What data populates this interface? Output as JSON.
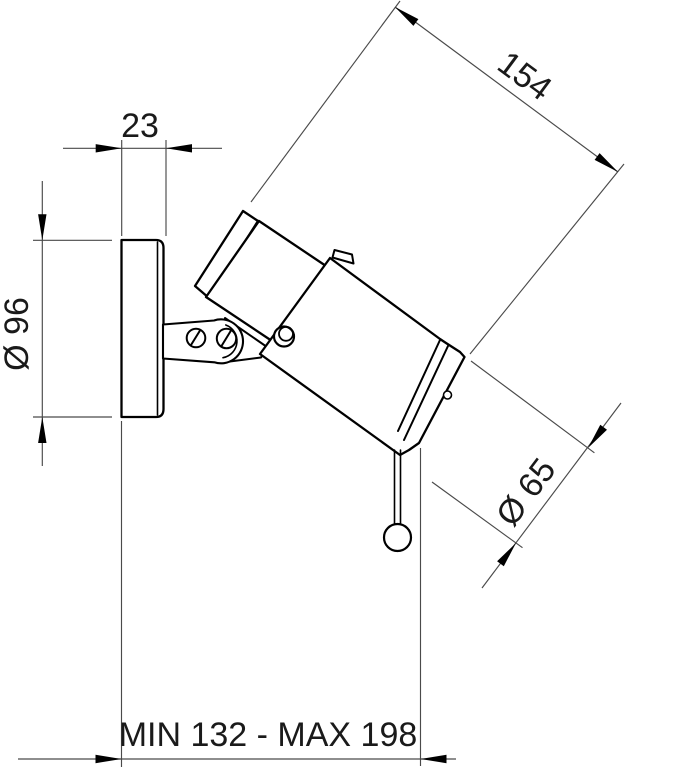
{
  "drawing": {
    "dimensions": {
      "plate_depth": "23",
      "plate_diameter": "Ø 96",
      "body_length": "154",
      "body_diameter": "Ø 65",
      "wall_extension": "MIN 132 - MAX 198"
    },
    "colors": {
      "background": "#ffffff",
      "outline": "#000000",
      "dimension_line": "#4a4a4a",
      "text": "#1a1a1a"
    }
  }
}
